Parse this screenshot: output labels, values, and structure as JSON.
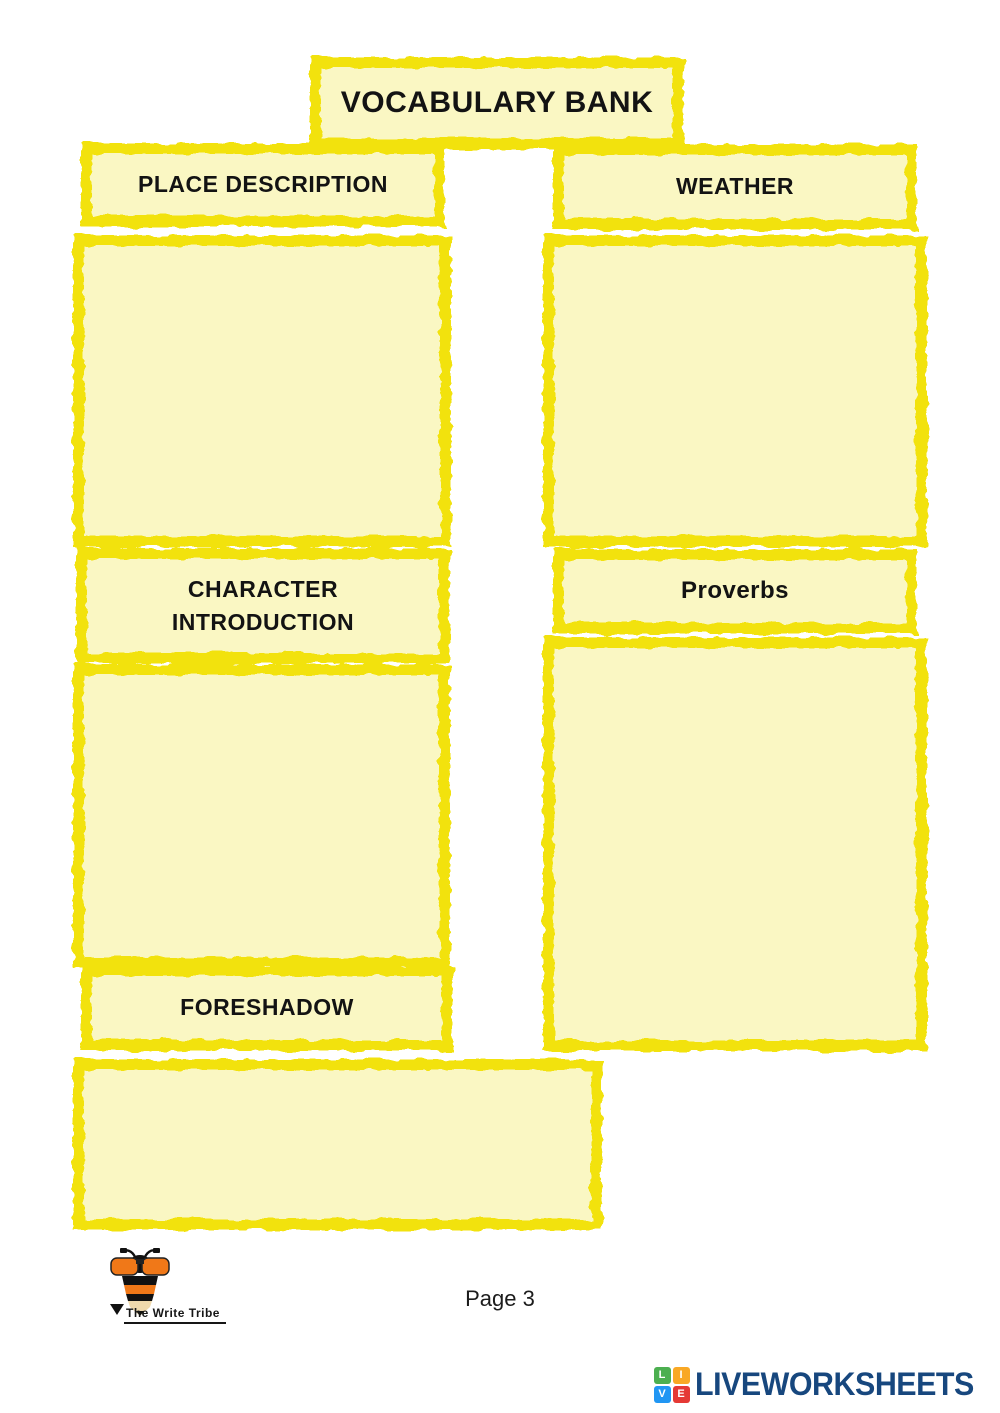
{
  "colors": {
    "box_border": "#F2E20D",
    "box_fill": "#FAF7C3"
  },
  "title_box": {
    "label": "VOCABULARY BANK"
  },
  "sections": [
    {
      "id": "place-description",
      "label": "PLACE DESCRIPTION",
      "answer": ""
    },
    {
      "id": "weather",
      "label": "WEATHER",
      "answer": ""
    },
    {
      "id": "character-introduction",
      "label": "CHARACTER INTRODUCTION",
      "answer": ""
    },
    {
      "id": "proverbs",
      "label": "Proverbs",
      "answer": ""
    },
    {
      "id": "foreshadow",
      "label": "FORESHADOW",
      "answer": ""
    }
  ],
  "footer": {
    "page_label": "Page 3",
    "write_tribe_name": "The Write Tribe"
  },
  "branding": {
    "liveworksheets": {
      "wordmark": "LIVEWORKSHEETS",
      "text_color": "#17477E",
      "tiles": [
        {
          "letter": "L",
          "color": "#4CAF50"
        },
        {
          "letter": "I",
          "color": "#F9A825"
        },
        {
          "letter": "V",
          "color": "#2196F3"
        },
        {
          "letter": "E",
          "color": "#E53935"
        }
      ]
    }
  }
}
